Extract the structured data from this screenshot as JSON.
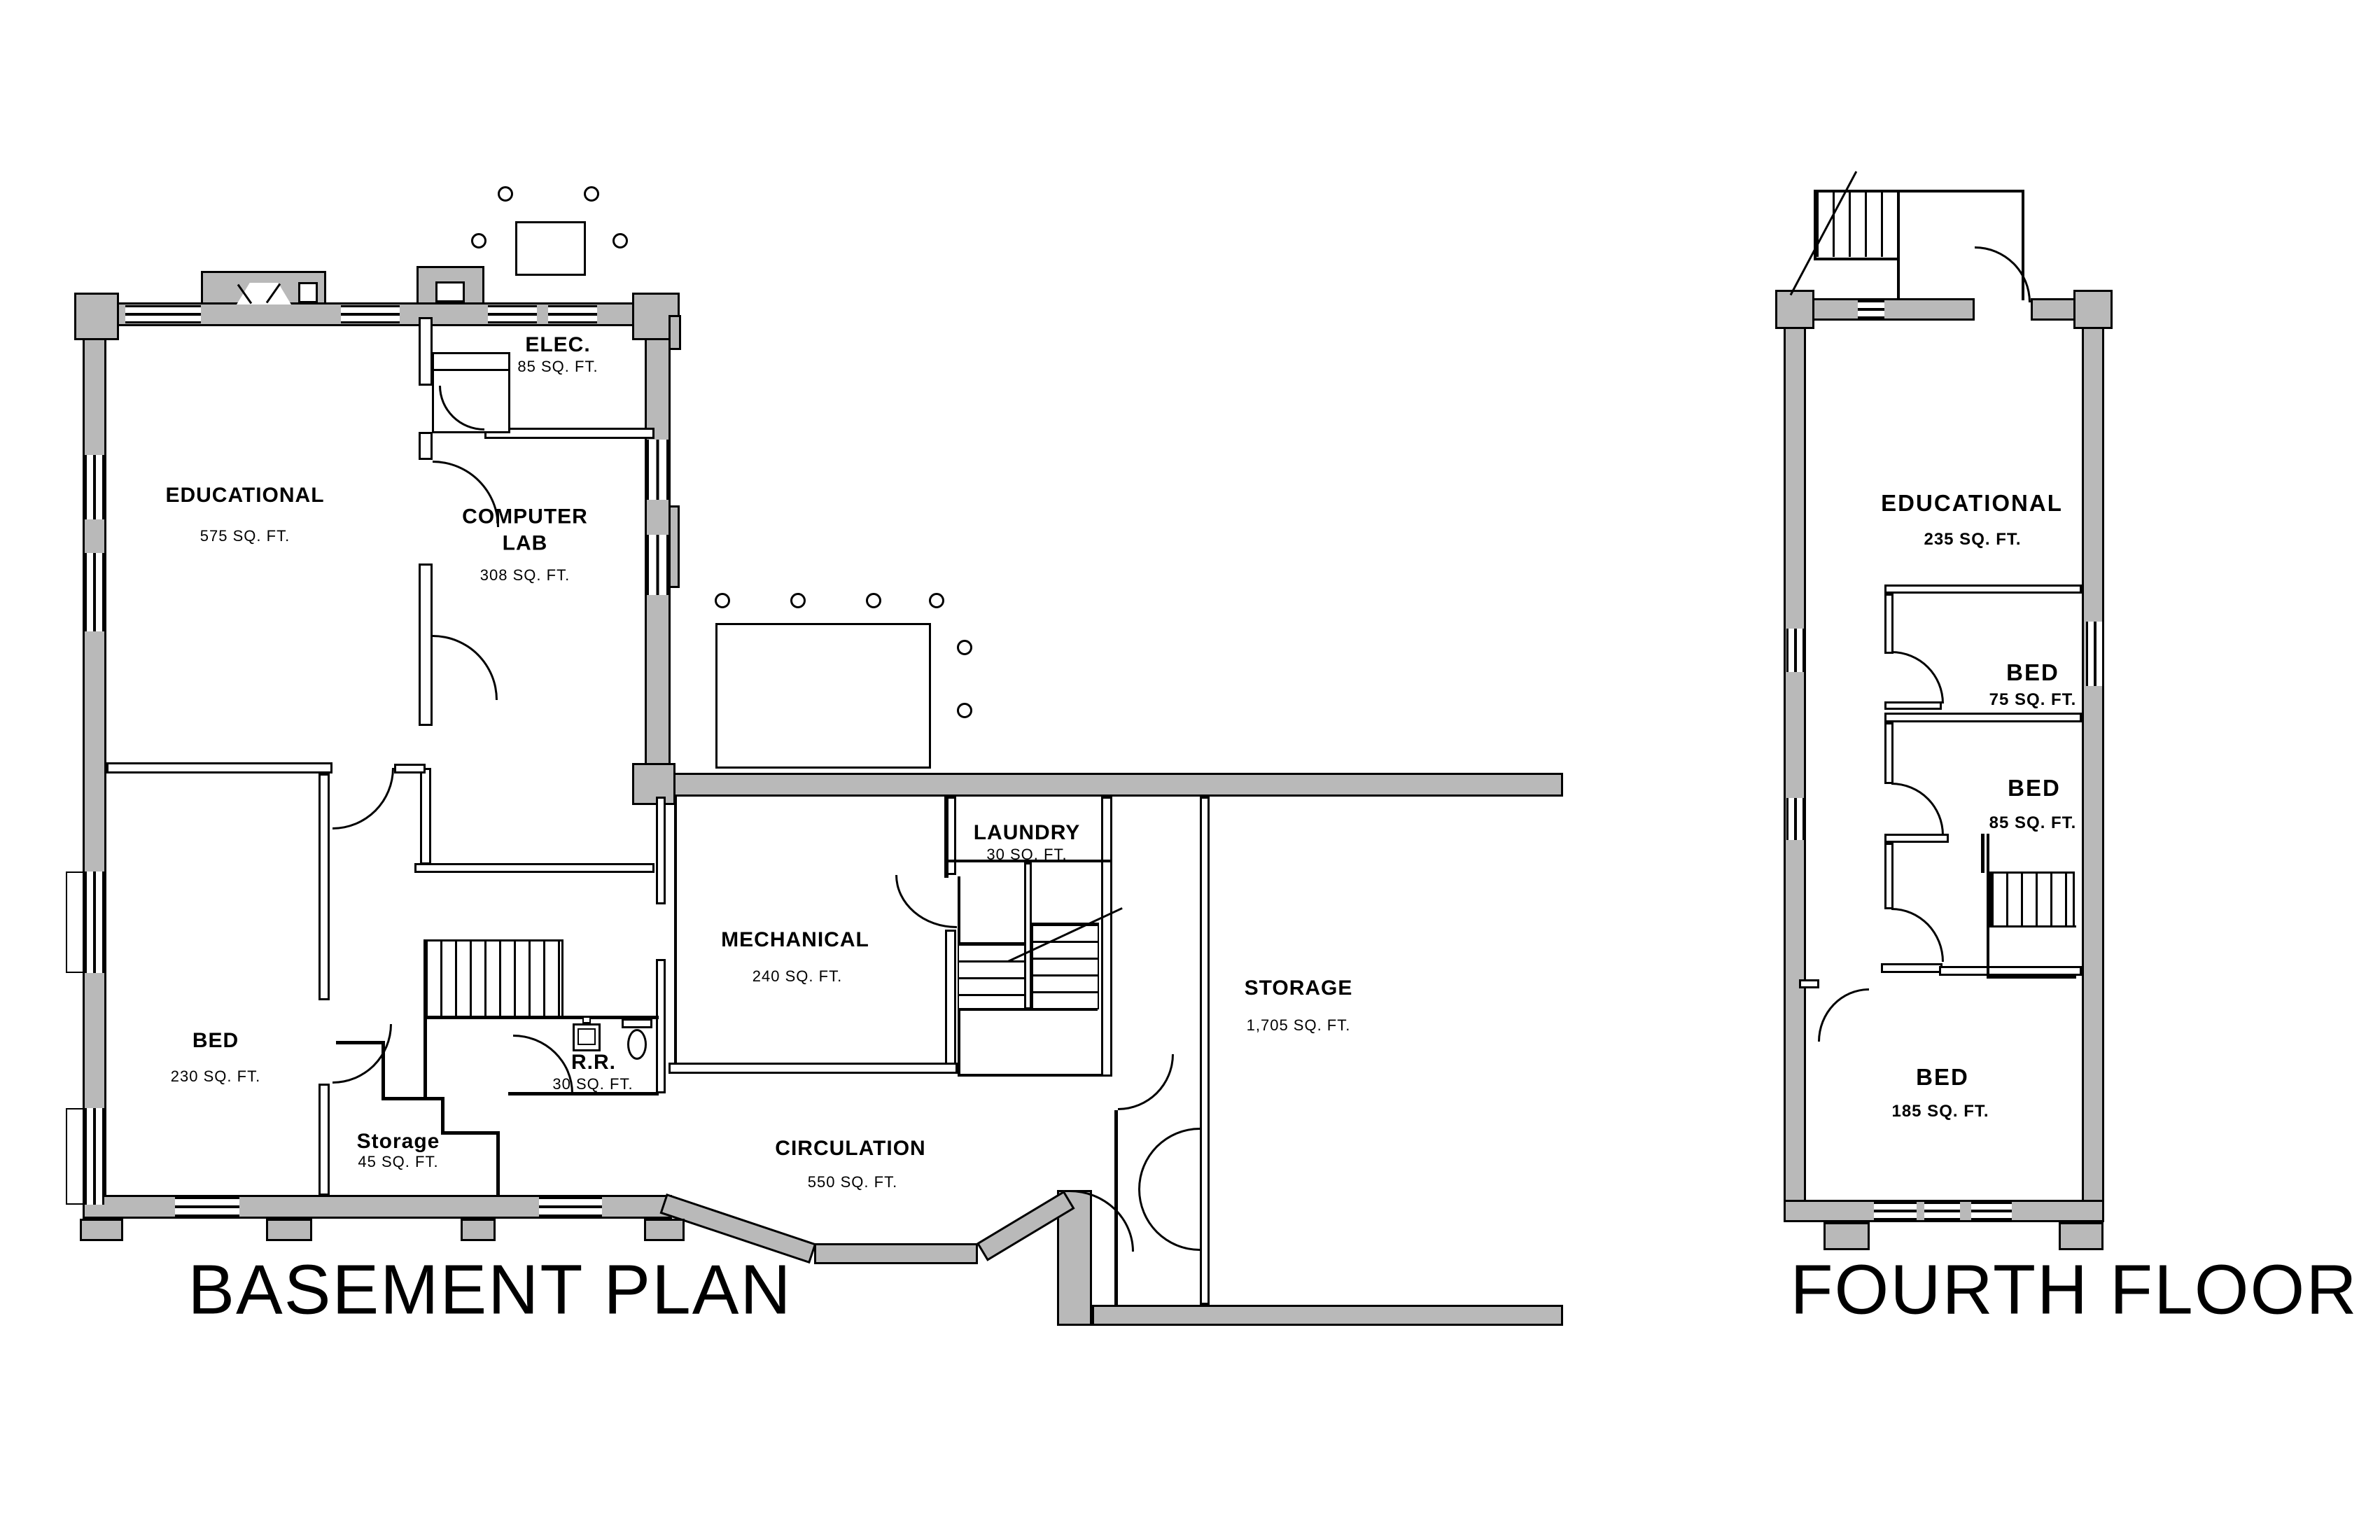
{
  "document": {
    "type": "architectural floor plan drawing",
    "sheet_background": "#ffffff"
  },
  "colors": {
    "wall_fill": "#b9b9b9",
    "line": "#000000"
  },
  "plans": {
    "basement": {
      "title": "BASEMENT PLAN",
      "rooms": {
        "educational": {
          "name": "EDUCATIONAL",
          "area": "575 SQ. FT."
        },
        "computer_lab": {
          "name": "COMPUTER LAB",
          "area": "308 SQ. FT."
        },
        "elec": {
          "name": "ELEC.",
          "area": "85 SQ. FT."
        },
        "bed": {
          "name": "BED",
          "area": "230 SQ. FT."
        },
        "storage_small": {
          "name": "Storage",
          "area": "45 SQ. FT."
        },
        "restroom": {
          "name": "R.R.",
          "area": "30 SQ. FT."
        },
        "mechanical": {
          "name": "MECHANICAL",
          "area": "240 SQ. FT."
        },
        "laundry": {
          "name": "LAUNDRY",
          "area": "30 SQ. FT."
        },
        "storage_large": {
          "name": "STORAGE",
          "area": "1,705 SQ. FT."
        },
        "circulation": {
          "name": "CIRCULATION",
          "area": "550 SQ. FT."
        }
      }
    },
    "fourth": {
      "title": "FOURTH FLOOR",
      "rooms": {
        "educational": {
          "name": "EDUCATIONAL",
          "area": "235 SQ. FT."
        },
        "bed_75": {
          "name": "BED",
          "area": "75 SQ. FT."
        },
        "bed_85": {
          "name": "BED",
          "area": "85 SQ. FT."
        },
        "bed_185": {
          "name": "BED",
          "area": "185 SQ. FT."
        }
      }
    }
  }
}
